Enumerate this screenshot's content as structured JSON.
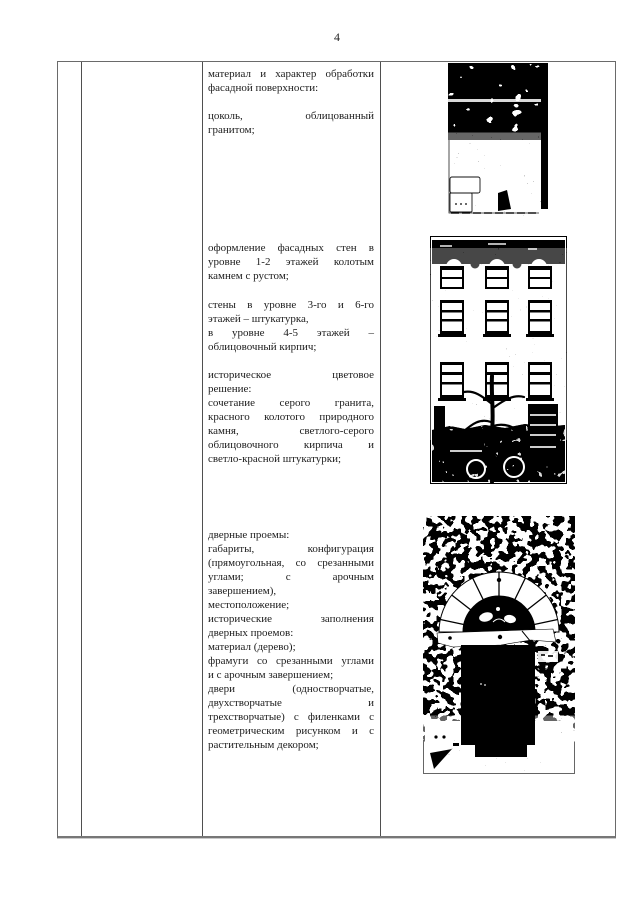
{
  "page": {
    "number": "4"
  },
  "colors": {
    "ink": "#1c1c1c",
    "table_border": "#4f4f4f",
    "photo_black": "#000000"
  },
  "table": {
    "col1": "",
    "col2": "",
    "text_column": {
      "blocks": [
        {
          "gap_before": 0,
          "lines": [
            [
              "материал и характер обработки",
              1
            ],
            [
              "фасадной поверхности:",
              0
            ]
          ]
        },
        {
          "gap_before": 14,
          "lines": [
            [
              "цоколь, облицованный",
              1
            ],
            [
              "гранитом;",
              0
            ]
          ]
        },
        {
          "gap_before": 104,
          "lines": [
            [
              "оформление фасадных стен в",
              1
            ],
            [
              "уровне 1-2 этажей колотым",
              1
            ],
            [
              "камнем с рустом;",
              0
            ]
          ]
        },
        {
          "gap_before": 15,
          "lines": [
            [
              "стены в уровне 3-го и 6-го",
              1
            ],
            [
              "этажей – штукатурка,",
              0
            ],
            [
              "в уровне 4-5 этажей –",
              1
            ],
            [
              "облицовочный кирпич;",
              0
            ]
          ]
        },
        {
          "gap_before": 14,
          "lines": [
            [
              "историческое цветовое",
              1
            ],
            [
              "решение:",
              0
            ],
            [
              "сочетание серого гранита,",
              1
            ],
            [
              "красного колотого природного",
              1
            ],
            [
              "камня, светлого-серого",
              1
            ],
            [
              "облицовочного кирпича и",
              1
            ],
            [
              "светло-красной штукатурки;",
              0
            ]
          ]
        },
        {
          "gap_before": 62,
          "lines": [
            [
              "дверные проемы:",
              0
            ],
            [
              "габариты, конфигурация",
              1
            ],
            [
              "(прямоугольная, со срезанными",
              1
            ],
            [
              "углами; с арочным",
              1
            ],
            [
              "завершением),",
              0
            ],
            [
              "местоположение;",
              0
            ],
            [
              "исторические заполнения",
              1
            ],
            [
              "дверных проемов:",
              0
            ],
            [
              "материал (дерево);",
              0
            ],
            [
              "фрамуги со срезанными углами",
              1
            ],
            [
              "и с арочным завершением;",
              0
            ],
            [
              "двери (одностворчатые,",
              1
            ],
            [
              "двухстворчатые и",
              1
            ],
            [
              "трехстворчатые) с филенками с",
              1
            ],
            [
              "геометрическим рисунком и с",
              1
            ],
            [
              "растительным декором;",
              0
            ]
          ]
        }
      ]
    },
    "photos": [
      {
        "name": "granite-plinth-photo"
      },
      {
        "name": "facade-photo"
      },
      {
        "name": "doorway-photo"
      }
    ]
  }
}
